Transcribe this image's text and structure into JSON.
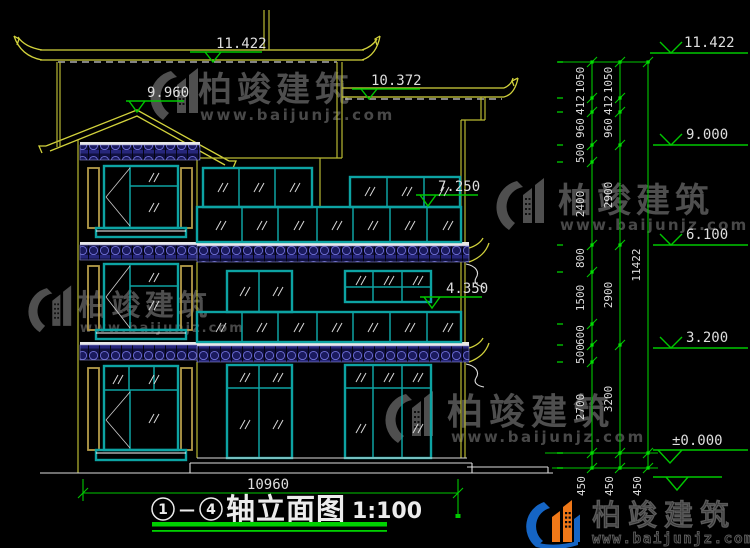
{
  "drawing": {
    "levels": {
      "top": "11.422",
      "gable": "9.960",
      "roof2": "10.372",
      "floor3": "7.250",
      "floor2": "4.350",
      "r1": "11.422",
      "r2": "9.000",
      "r3": "6.100",
      "r4": "3.200",
      "r5": "±0.000"
    },
    "chains": {
      "a": [
        "1050",
        "412",
        "960",
        "500",
        "2400",
        "800",
        "1500",
        "600",
        "500",
        "2700",
        "450"
      ],
      "b": [
        "1050",
        "412",
        "960",
        "2900",
        "2900",
        "3200",
        "450"
      ],
      "c": [
        "11422",
        "450"
      ]
    },
    "bottom_dim": "10960",
    "title": {
      "n1": "1",
      "sep": "—",
      "n2": "4",
      "text": "轴立面图",
      "scale": "1:100"
    }
  },
  "watermark": {
    "brand": "柏竣建筑",
    "url": "www.baijunjz.com"
  },
  "logo": {
    "brand": "柏竣建筑",
    "url": "www.baijunjz.com"
  },
  "colors": {
    "background": "#000000",
    "dim_green": "#00c800",
    "frame_teal": "#0da3a3",
    "wall_yellow": "#b9b932",
    "tile_navy": "#10103f",
    "text_white": "#dedede",
    "logo_blue": "#1565c5",
    "logo_orange": "#f07818"
  }
}
